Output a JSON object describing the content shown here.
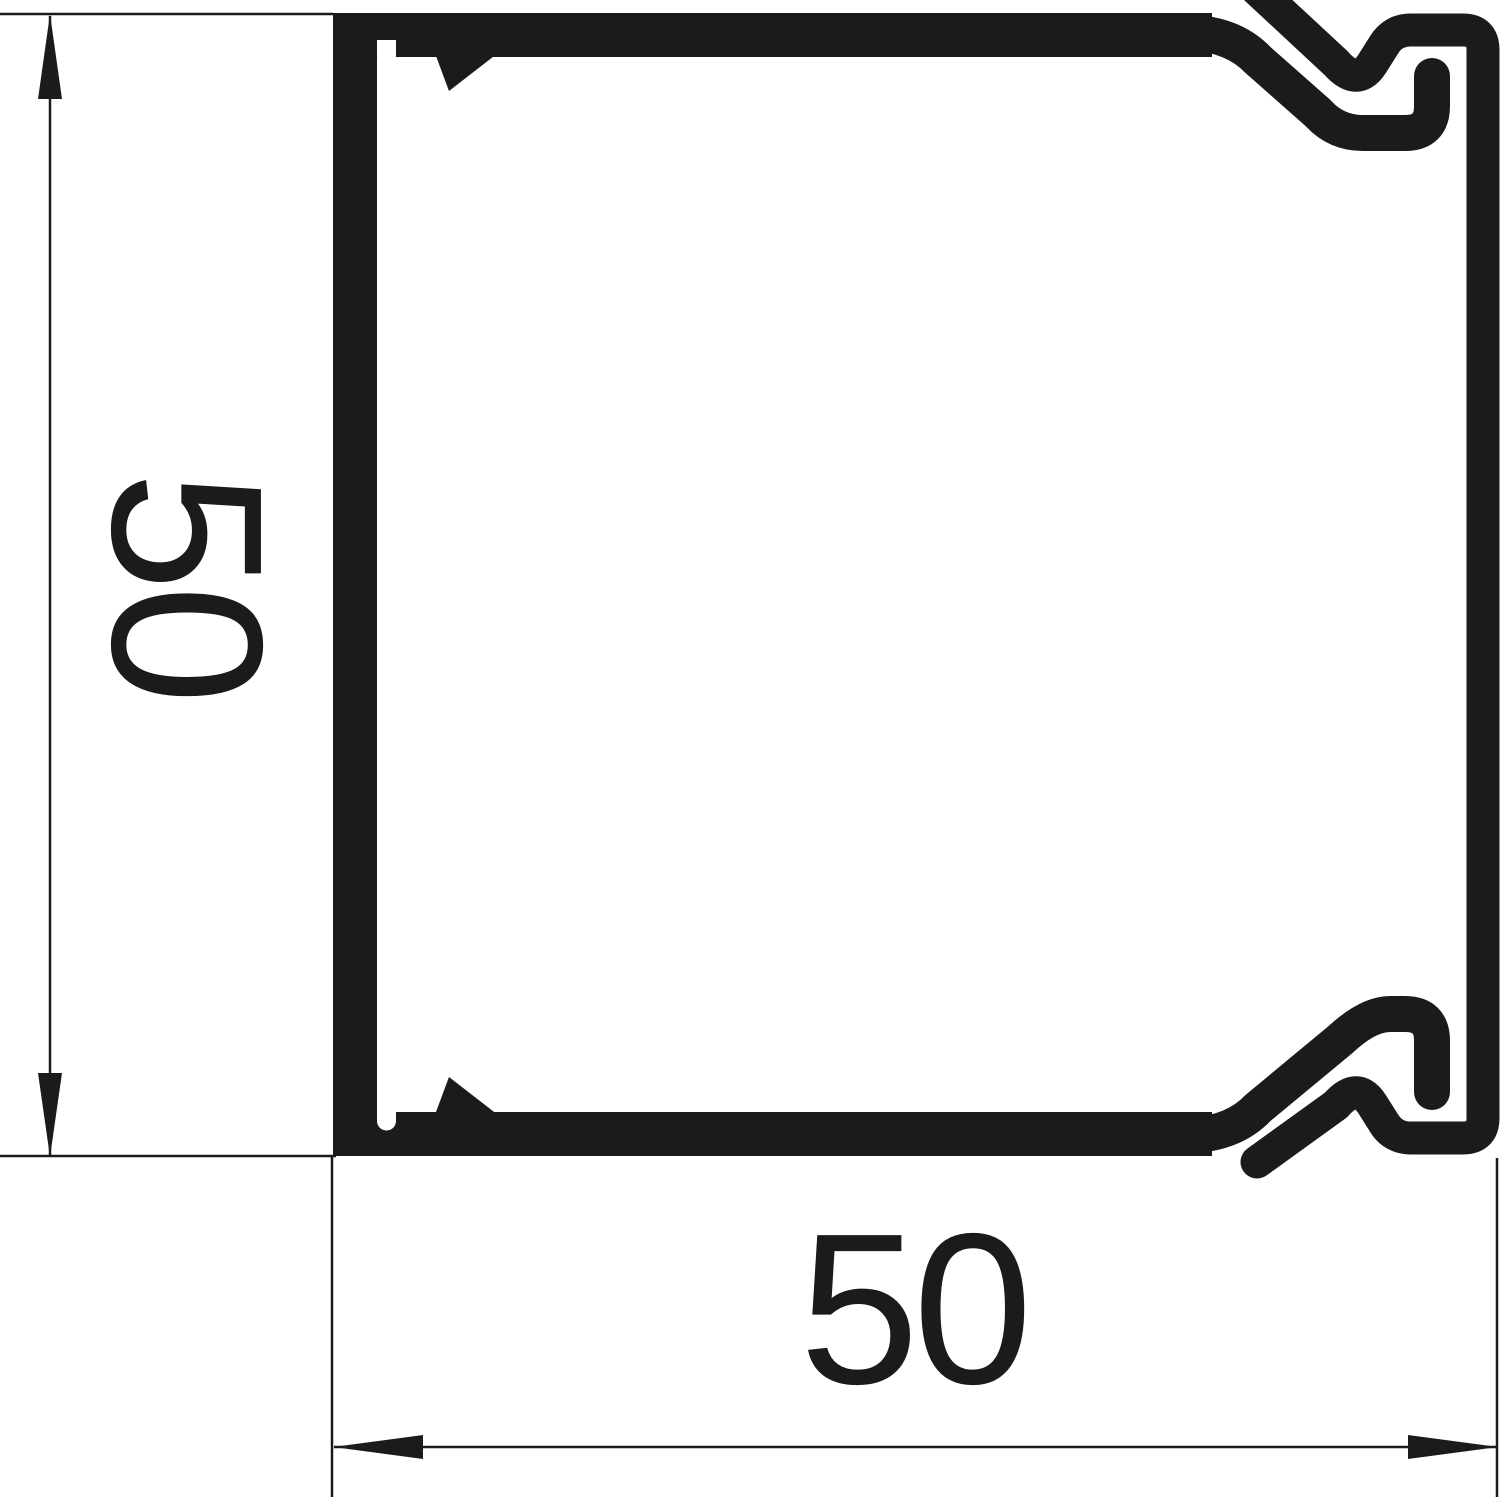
{
  "page": {
    "title": "Technical drawing: trunking profile cross-section 50 x 50",
    "background": "#ffffff"
  },
  "drawing": {
    "ink_color": "#1b1b1b",
    "background_color": "#ffffff",
    "figure": "cable-trunking-profile-cross-section",
    "dimension_height": {
      "label": "50"
    },
    "dimension_width": {
      "label": "50"
    }
  }
}
